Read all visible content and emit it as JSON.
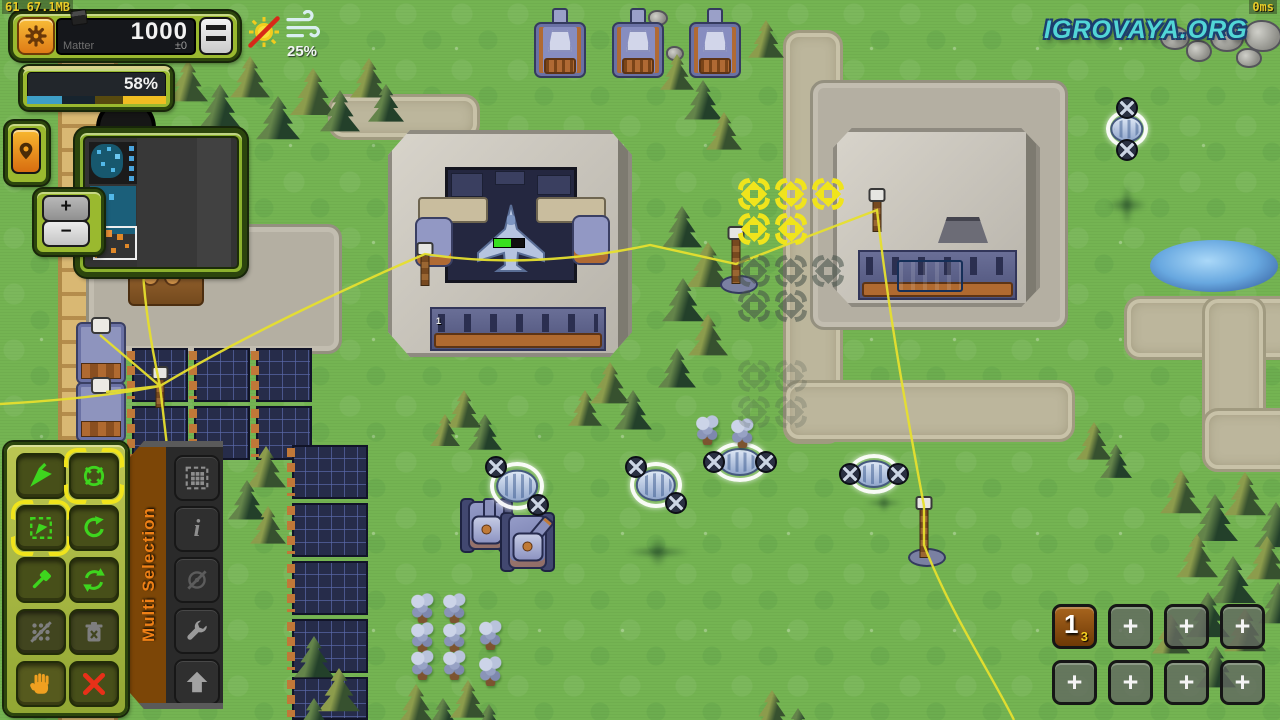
{
  "hud": {
    "debug_text": "61 67.1MB",
    "ping_text": "0ms",
    "watermark_text": "IGROVAYA.ORG",
    "matter": {
      "value": "1000",
      "label": "Matter",
      "delta": "±0"
    },
    "progress": {
      "percent": "58%"
    },
    "weather": {
      "wind_percent": "25%"
    }
  },
  "zoom_controls": {
    "in_label": "+",
    "out_label": "−"
  },
  "selection_panel": {
    "title": "Multi Selection",
    "info_glyph": "i",
    "buttons": [
      "select-all",
      "info",
      "no-auto-attack",
      "repair",
      "upgrade"
    ]
  },
  "tool_panel": {
    "buttons": [
      "move-command",
      "attack-target",
      "box-select",
      "rotate-queue",
      "build-hammer",
      "loop-waypoints",
      "network-disabled",
      "delete-disabled",
      "pan-hand",
      "cancel"
    ]
  },
  "unit_groups": {
    "group1_number": "1",
    "group1_count": "3",
    "empty_slot_label": "+"
  },
  "world": {
    "factory_queue_label": "1"
  },
  "icons": {
    "gear-icon": "svg gear",
    "menu-icon": "css three bars",
    "location-pin-icon": "svg map pin",
    "zoom-in-icon": "+",
    "zoom-out-icon": "−",
    "no-sun-icon": "svg sun with red slash",
    "wind-icon": "svg wind lines",
    "move-cursor-icon": "svg green arrow",
    "attack-target-icon": "svg green crosshair circle",
    "box-select-icon": "svg dashed box with arrow",
    "rotate-icon": "svg circular arrow",
    "hammer-icon": "svg hammer",
    "loop-icon": "svg double circular arrows",
    "network-icon": "svg dots with slash",
    "trash-icon": "svg trash with x",
    "hand-icon": "svg orange hand",
    "cancel-icon": "svg red x",
    "select-all-icon": "svg dashed grid",
    "info-icon": "i",
    "no-attack-icon": "svg target with slash",
    "wrench-icon": "svg wrench",
    "upgrade-icon": "svg up arrow"
  },
  "colors": {
    "ui_frame_green": "#9ab92f",
    "ui_frame_dark": "#2c450d",
    "accent_orange": "#f09a28",
    "highlight_yellow": "#f0e41c",
    "power_line_yellow": "#e6df2e",
    "watermark_cyan": "#52d6d6",
    "grass_green": "#74b452",
    "selection_ring_white": "#ffffff",
    "progress_segments": [
      "#3e9ec6",
      "#17242e",
      "#57490f",
      "#f0bd22"
    ]
  }
}
